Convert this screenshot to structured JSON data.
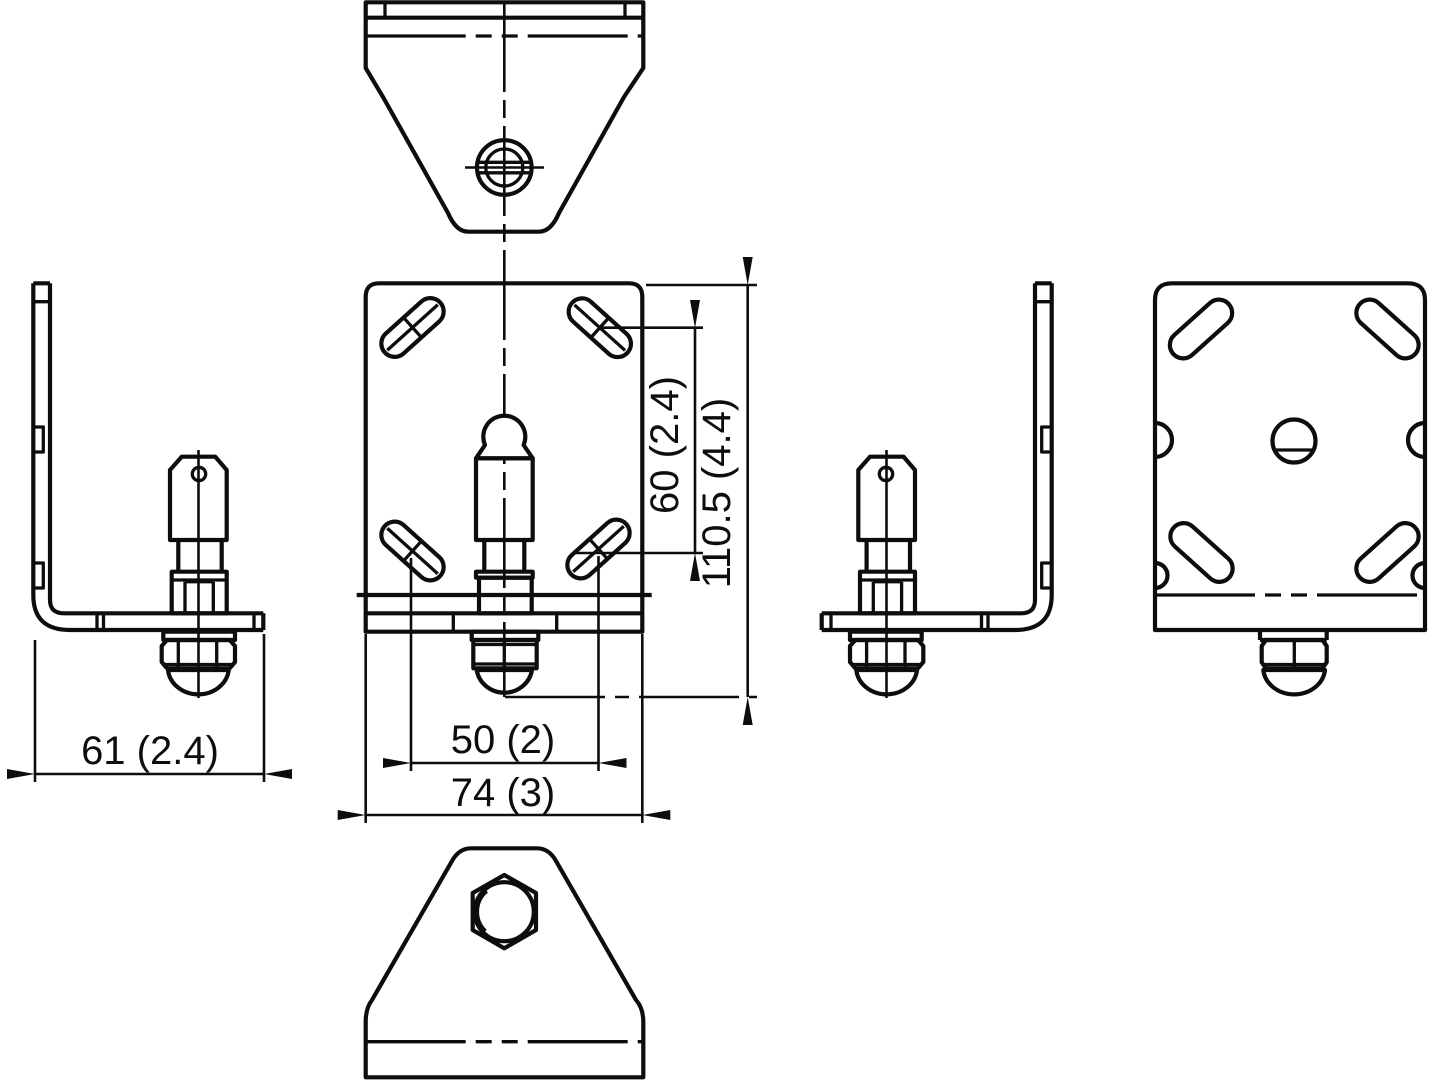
{
  "drawing": {
    "background": "#ffffff",
    "line_color": "#0d0d0d",
    "dimensions": [
      {
        "id": "side-depth",
        "label": "61 (2.4)"
      },
      {
        "id": "slot-spacing-horizontal",
        "label": "50 (2)"
      },
      {
        "id": "overall-width",
        "label": "74 (3)"
      },
      {
        "id": "slot-spacing-vertical",
        "label": "60 (2.4)"
      },
      {
        "id": "overall-height",
        "label": "110.5 (4.4)"
      }
    ]
  }
}
